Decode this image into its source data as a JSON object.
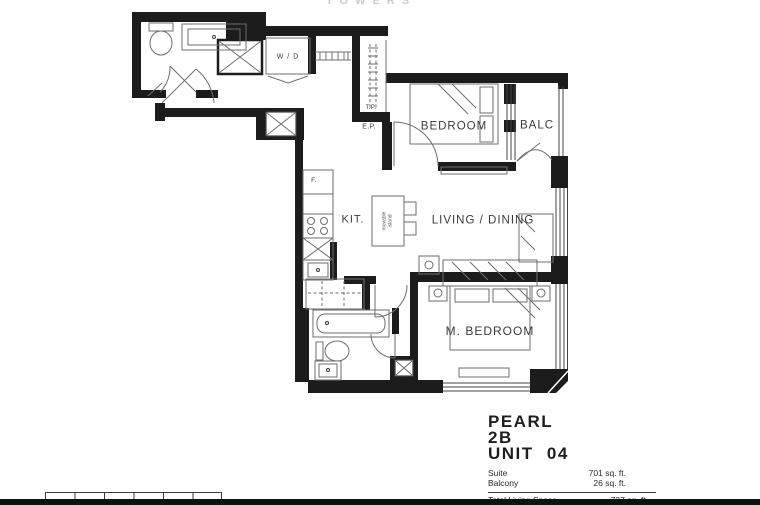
{
  "watermark": {
    "text": "TOWERS"
  },
  "rooms": {
    "laundry": {
      "label": "W / D"
    },
    "bedroom": {
      "label": "BEDROOM"
    },
    "balcony": {
      "label": "BALC"
    },
    "telephone_panel": {
      "label": "T.P."
    },
    "electrical_panel": {
      "label": "E.P."
    },
    "kitchen": {
      "label": "KIT."
    },
    "island": {
      "label": "movable island"
    },
    "living_dining": {
      "label": "LIVING / DINING"
    },
    "master_bedroom": {
      "label": "M. BEDROOM"
    },
    "fridge": {
      "label": "F."
    }
  },
  "info": {
    "project_name": "PEARL",
    "plan_type": "2B",
    "unit": "UNIT 04",
    "areas": [
      {
        "label": "Suite",
        "value": "701 sq. ft."
      },
      {
        "label": "Balcony",
        "value": "26 sq. ft."
      }
    ],
    "total_label": "Total Living Space",
    "total_value": "727 sq. ft."
  },
  "scale_bar": {
    "segments": 6
  },
  "colors": {
    "wall": "#1c1c1c",
    "fixture_line": "#6e6e6e",
    "label_text": "#3a3a3a",
    "watermark_text": "#cbcbcb",
    "background": "#ffffff"
  }
}
